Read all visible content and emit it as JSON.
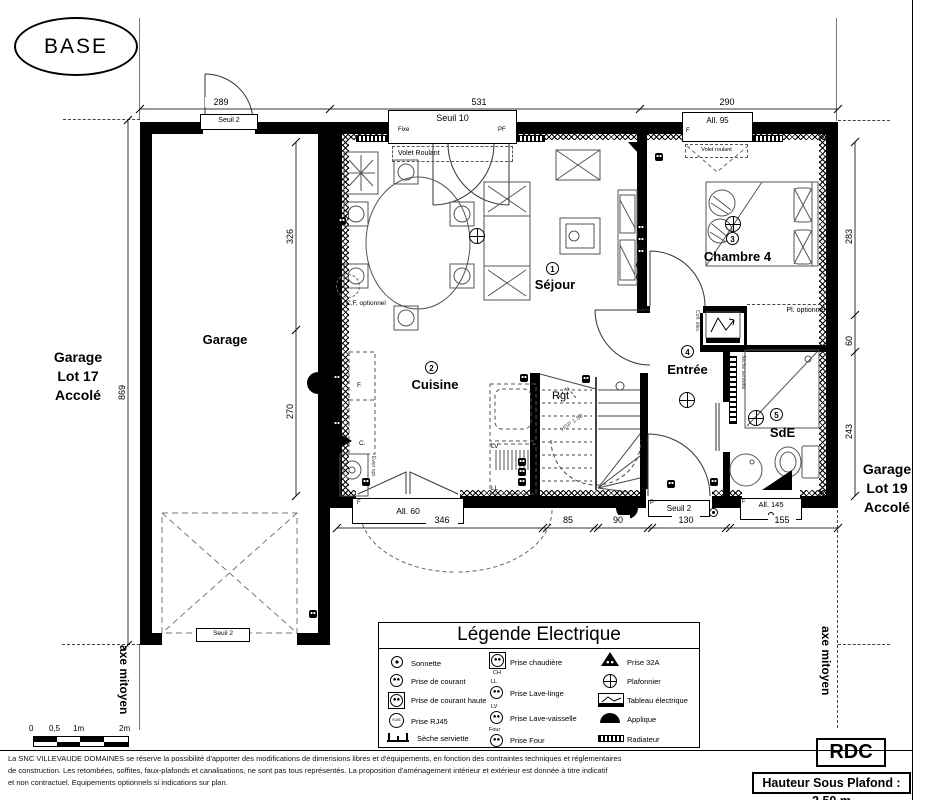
{
  "base_label": "BASE",
  "floor_label": "RDC",
  "ceiling_label": "Hauteur Sous Plafond : 2.50 m",
  "disclaimer": {
    "l1": "La SNC VILLEVAUDE DOMAINES se réserve la possibilité d'apporter des modifications de dimensions libres et d'équipements, en fonction des contraintes techniques et réglementaires",
    "l2": "de construction. Les retombées, soffites, faux-plafonds et canalisations, ne sont pas tous représentés. La proposition d'aménagement intérieur et extérieur est donnée à titre indicatif",
    "l3": "et non contractuel. Equipements optionnels si indications sur plan."
  },
  "neighbor_left": {
    "l1": "Garage",
    "l2": "Lot 17",
    "l3": "Accolé"
  },
  "neighbor_right": {
    "l1": "Garage",
    "l2": "Lot 19",
    "l3": "Accolé"
  },
  "axe_left": "axe mitoyen",
  "axe_right": "axe mitoyen",
  "scalebar": {
    "t0": "0",
    "t1": "0,5",
    "t2": "1m",
    "t3": "2m"
  },
  "rooms": {
    "sejour": {
      "num": "1",
      "name": "Séjour"
    },
    "cuisine": {
      "num": "2",
      "name": "Cuisine"
    },
    "chambre": {
      "num": "3",
      "name": "Chambre 4"
    },
    "entree": {
      "num": "4",
      "name": "Entrée"
    },
    "sde": {
      "num": "5",
      "name": "SdE"
    },
    "garage": {
      "name": "Garage"
    }
  },
  "dims": {
    "top": [
      "289",
      "531",
      "290"
    ],
    "bottom": [
      "346",
      "85",
      "90",
      "130",
      "155"
    ],
    "left": "869",
    "inner_left": [
      "326",
      "270"
    ],
    "right": [
      "283",
      "60",
      "243"
    ]
  },
  "openings": {
    "garage_top": "Seuil 2",
    "bay": "Seuil 10",
    "bay_fixe": "Fixe",
    "bay_pf": "PF",
    "bay_volet": "Volet Roulant",
    "chambre_win": "All. 95",
    "chambre_volet": "Volet roulant",
    "f": "F",
    "p": "P",
    "kitchen_win": "All. 60",
    "entry": "Seuil 2",
    "sde_win": "All. 145",
    "garage_door": "Seuil 2"
  },
  "annotations": {
    "cf": "C,F, optionnel",
    "pl": "Pl. optionnel",
    "coffre": "Coff. élec.",
    "seche": "Sèche serviette",
    "rgt": "Rgt",
    "hsp": "HSP 1.80",
    "frigo": "F.",
    "cuisson": "C.",
    "lv": "LV",
    "ll": "LL",
    "evier": "Évier opt."
  },
  "legend": {
    "title": "Légende Electrique",
    "items": [
      {
        "icon": "sonnette",
        "label": "Sonnette"
      },
      {
        "icon": "prise",
        "label": "Prise de courant"
      },
      {
        "icon": "prise-haute",
        "label": "Prise de courant haute"
      },
      {
        "icon": "rj45",
        "label": "Prise RJ45",
        "icon_text": "RJ45"
      },
      {
        "icon": "seche-serviette",
        "label": "Sèche serviette"
      },
      {
        "icon": "prise-chaudiere",
        "label": "Prise chaudière",
        "tag": "CH"
      },
      {
        "icon": "prise-tag",
        "label": "Prise Lave-linge",
        "tag": "LL"
      },
      {
        "icon": "prise-tag",
        "label": "Prise Lave-vaisselle",
        "tag": "LV"
      },
      {
        "icon": "prise-tag",
        "label": "Prise Four",
        "tag": "Four"
      },
      {
        "icon": "prise32a",
        "label": "Prise 32A"
      },
      {
        "icon": "plafonnier",
        "label": "Plafonnier"
      },
      {
        "icon": "tableau",
        "label": "Tableau électrique"
      },
      {
        "icon": "applique",
        "label": "Applique"
      },
      {
        "icon": "radiateur",
        "label": "Radiateur"
      }
    ]
  }
}
